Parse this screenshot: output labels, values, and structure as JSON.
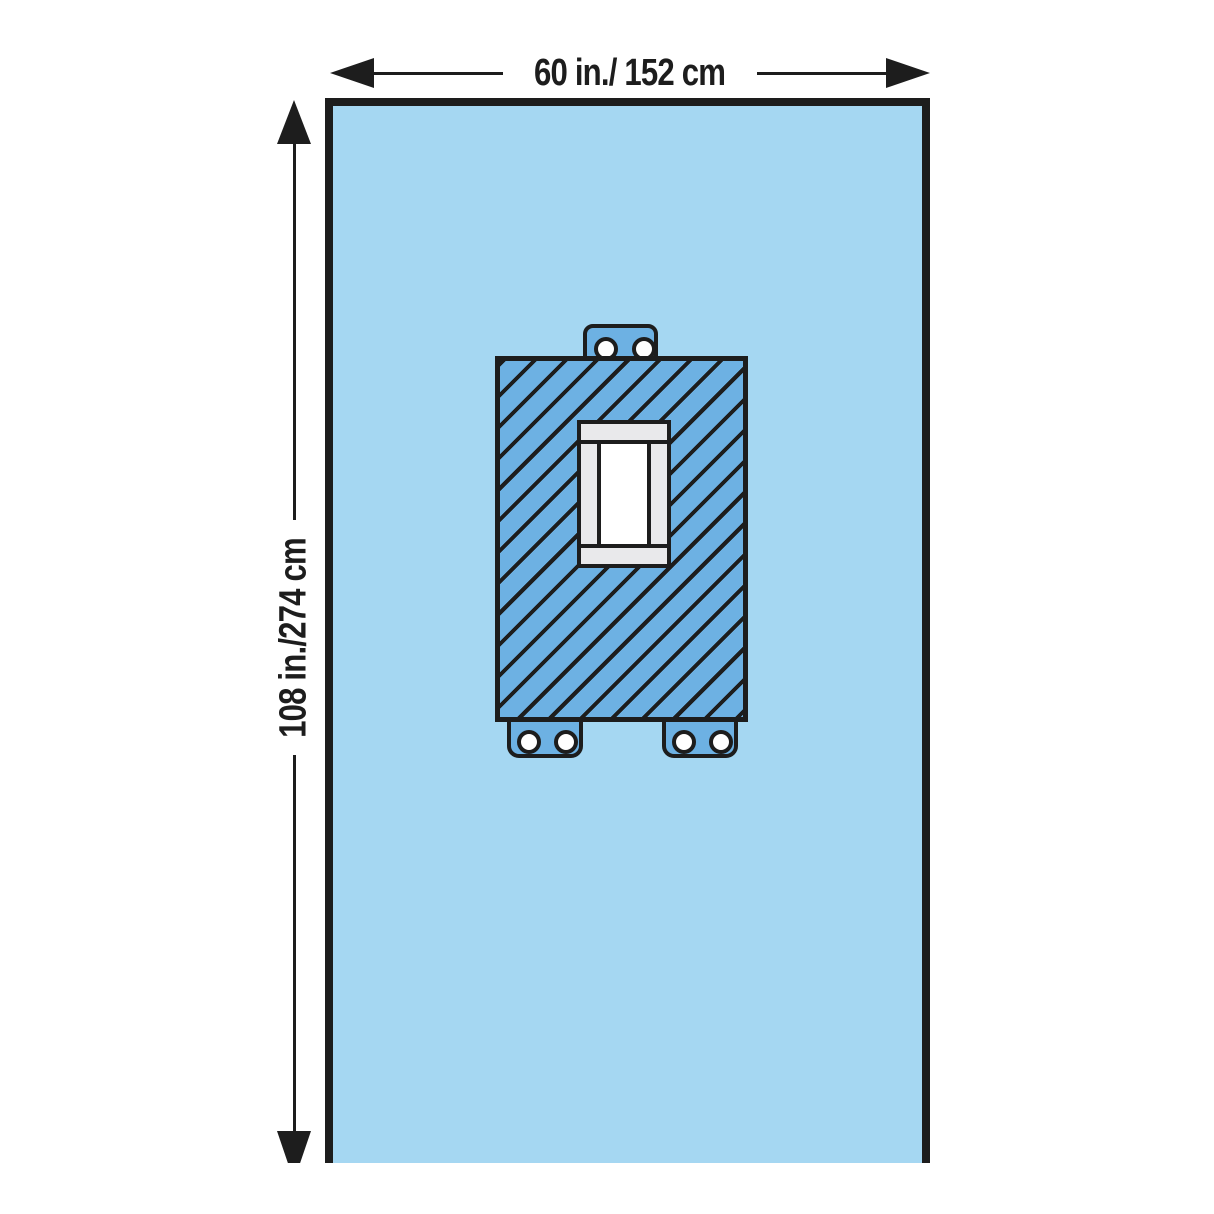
{
  "dimensions": {
    "width_label": "60 in./ 152 cm",
    "height_label": "108 in./274 cm"
  },
  "colors": {
    "background": "#ffffff",
    "drape_blue": "#a5d7f2",
    "reinforcement_blue": "#6db1e3",
    "outline_dark": "#1d1d1d",
    "frame_gray": "#e9e9eb",
    "fenestration_white": "#ffffff"
  }
}
